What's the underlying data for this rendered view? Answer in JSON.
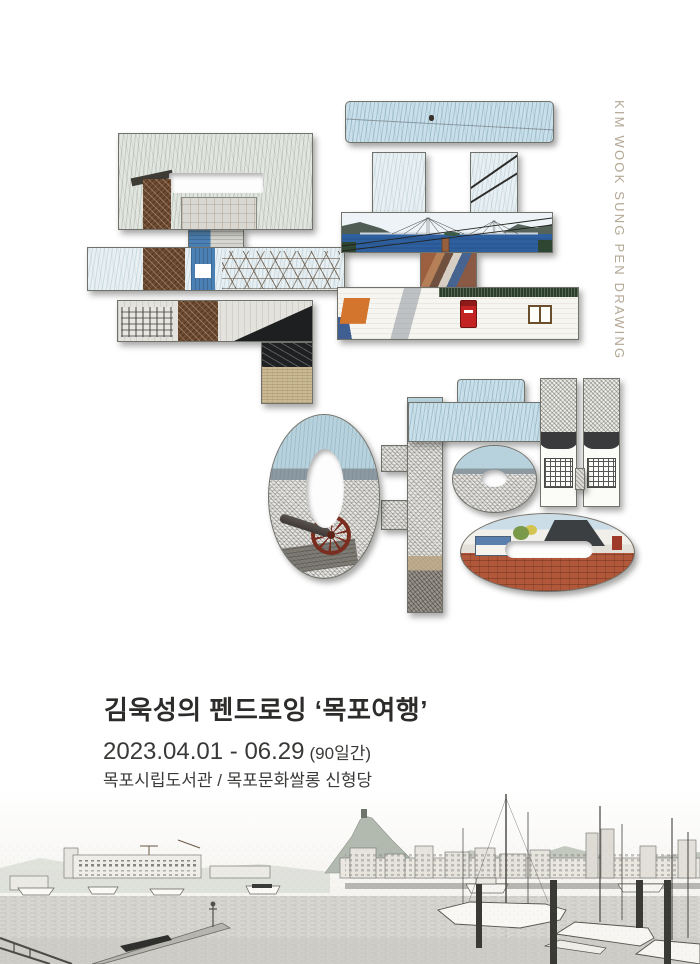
{
  "poster": {
    "width": 700,
    "height": 964,
    "background": "#ffffff"
  },
  "credit": {
    "vertical_text": "KIM WOOK SUNG  PEN DRAWING",
    "color": "#b3a795"
  },
  "artwork": {
    "word": "목포여행",
    "letters": [
      {
        "char": "목",
        "scene": "old-factory-tower-pen-drawing"
      },
      {
        "char": "포",
        "scene": "mokpo-bridge-and-village-pen-drawing"
      },
      {
        "char": "여",
        "scene": "city-panorama-with-cannon-pen-drawing"
      },
      {
        "char": "행",
        "scene": "hanok-and-temple-courtyard-pen-drawing"
      }
    ]
  },
  "caption": {
    "title": "김욱성의 펜드로잉 ‘목포여행’",
    "date_range": "2023.04.01 - 06.29",
    "duration": "(90일간)",
    "venue": "목포시립도서관 / 목포문화쌀롱 신형당"
  },
  "palette": {
    "sky_hatch": "#c9e0ea",
    "sea_blue": "#2e5f9e",
    "postbox_red": "#c32322",
    "tarp_orange": "#d4752e",
    "temple_ground": "#b2583a",
    "sand_tan": "#cab995",
    "ink_gray": "#4a4a46",
    "text_dark": "#2d2c2a"
  },
  "footer_art": {
    "label": "mokpo-harbor-panorama-pen-drawing"
  }
}
